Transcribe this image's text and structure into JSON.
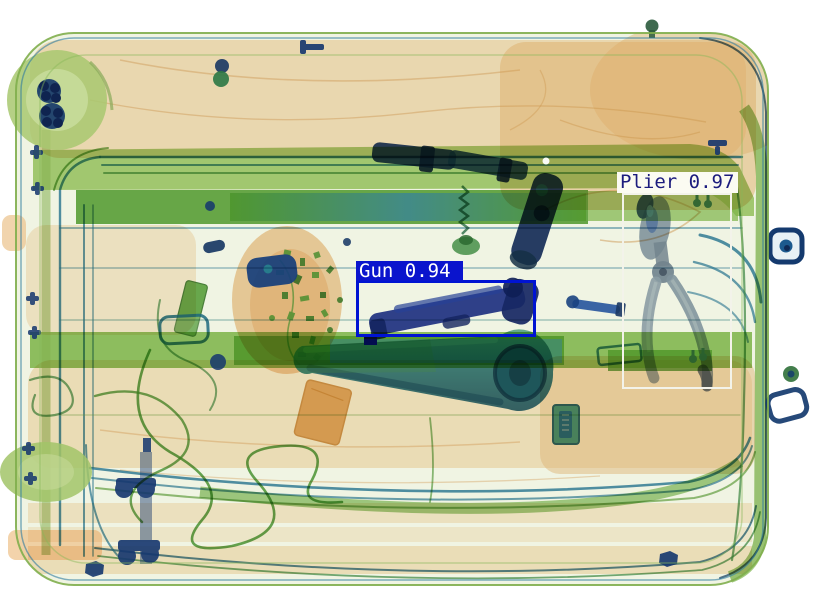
{
  "scene": {
    "description": "X-ray security scan of a suitcase with threat-detection overlays",
    "background_color": "#ffffff",
    "palette": {
      "organic_orange": "#f0c08a",
      "metal_navy": "#14366e",
      "case_green": "#8cc050",
      "tube_teal": "#2878a0"
    },
    "objects": [
      "suitcase",
      "wheels",
      "trolley-rails",
      "gun",
      "pliers",
      "bottle-cylinder",
      "lug-wrench",
      "spring-suction-cup",
      "wire-tangle",
      "circuit-cluster",
      "mouse-device",
      "battery-pack",
      "shoe-sole",
      "padlock",
      "side-handle"
    ]
  },
  "detections": [
    {
      "label": "Gun",
      "score": 0.94,
      "display": "Gun 0.94",
      "box": {
        "x": 356,
        "y": 280,
        "width": 180,
        "height": 57
      },
      "label_box": {
        "x": 356,
        "y": 261,
        "width": 107,
        "height": 20
      },
      "box_border": 3,
      "box_color": "#0014d2",
      "label_bg": "#0a14cd",
      "label_text_color": "#ffffff"
    },
    {
      "label": "Plier",
      "score": 0.97,
      "display": "Plier 0.97",
      "box": {
        "x": 622,
        "y": 193,
        "width": 110,
        "height": 196
      },
      "label_box": {
        "x": 617,
        "y": 172,
        "width": 121,
        "height": 21
      },
      "box_border": 2,
      "box_color": "#f3f3ea",
      "label_bg": "#fbfbf2",
      "label_text_color": "#1c1c7e"
    }
  ]
}
